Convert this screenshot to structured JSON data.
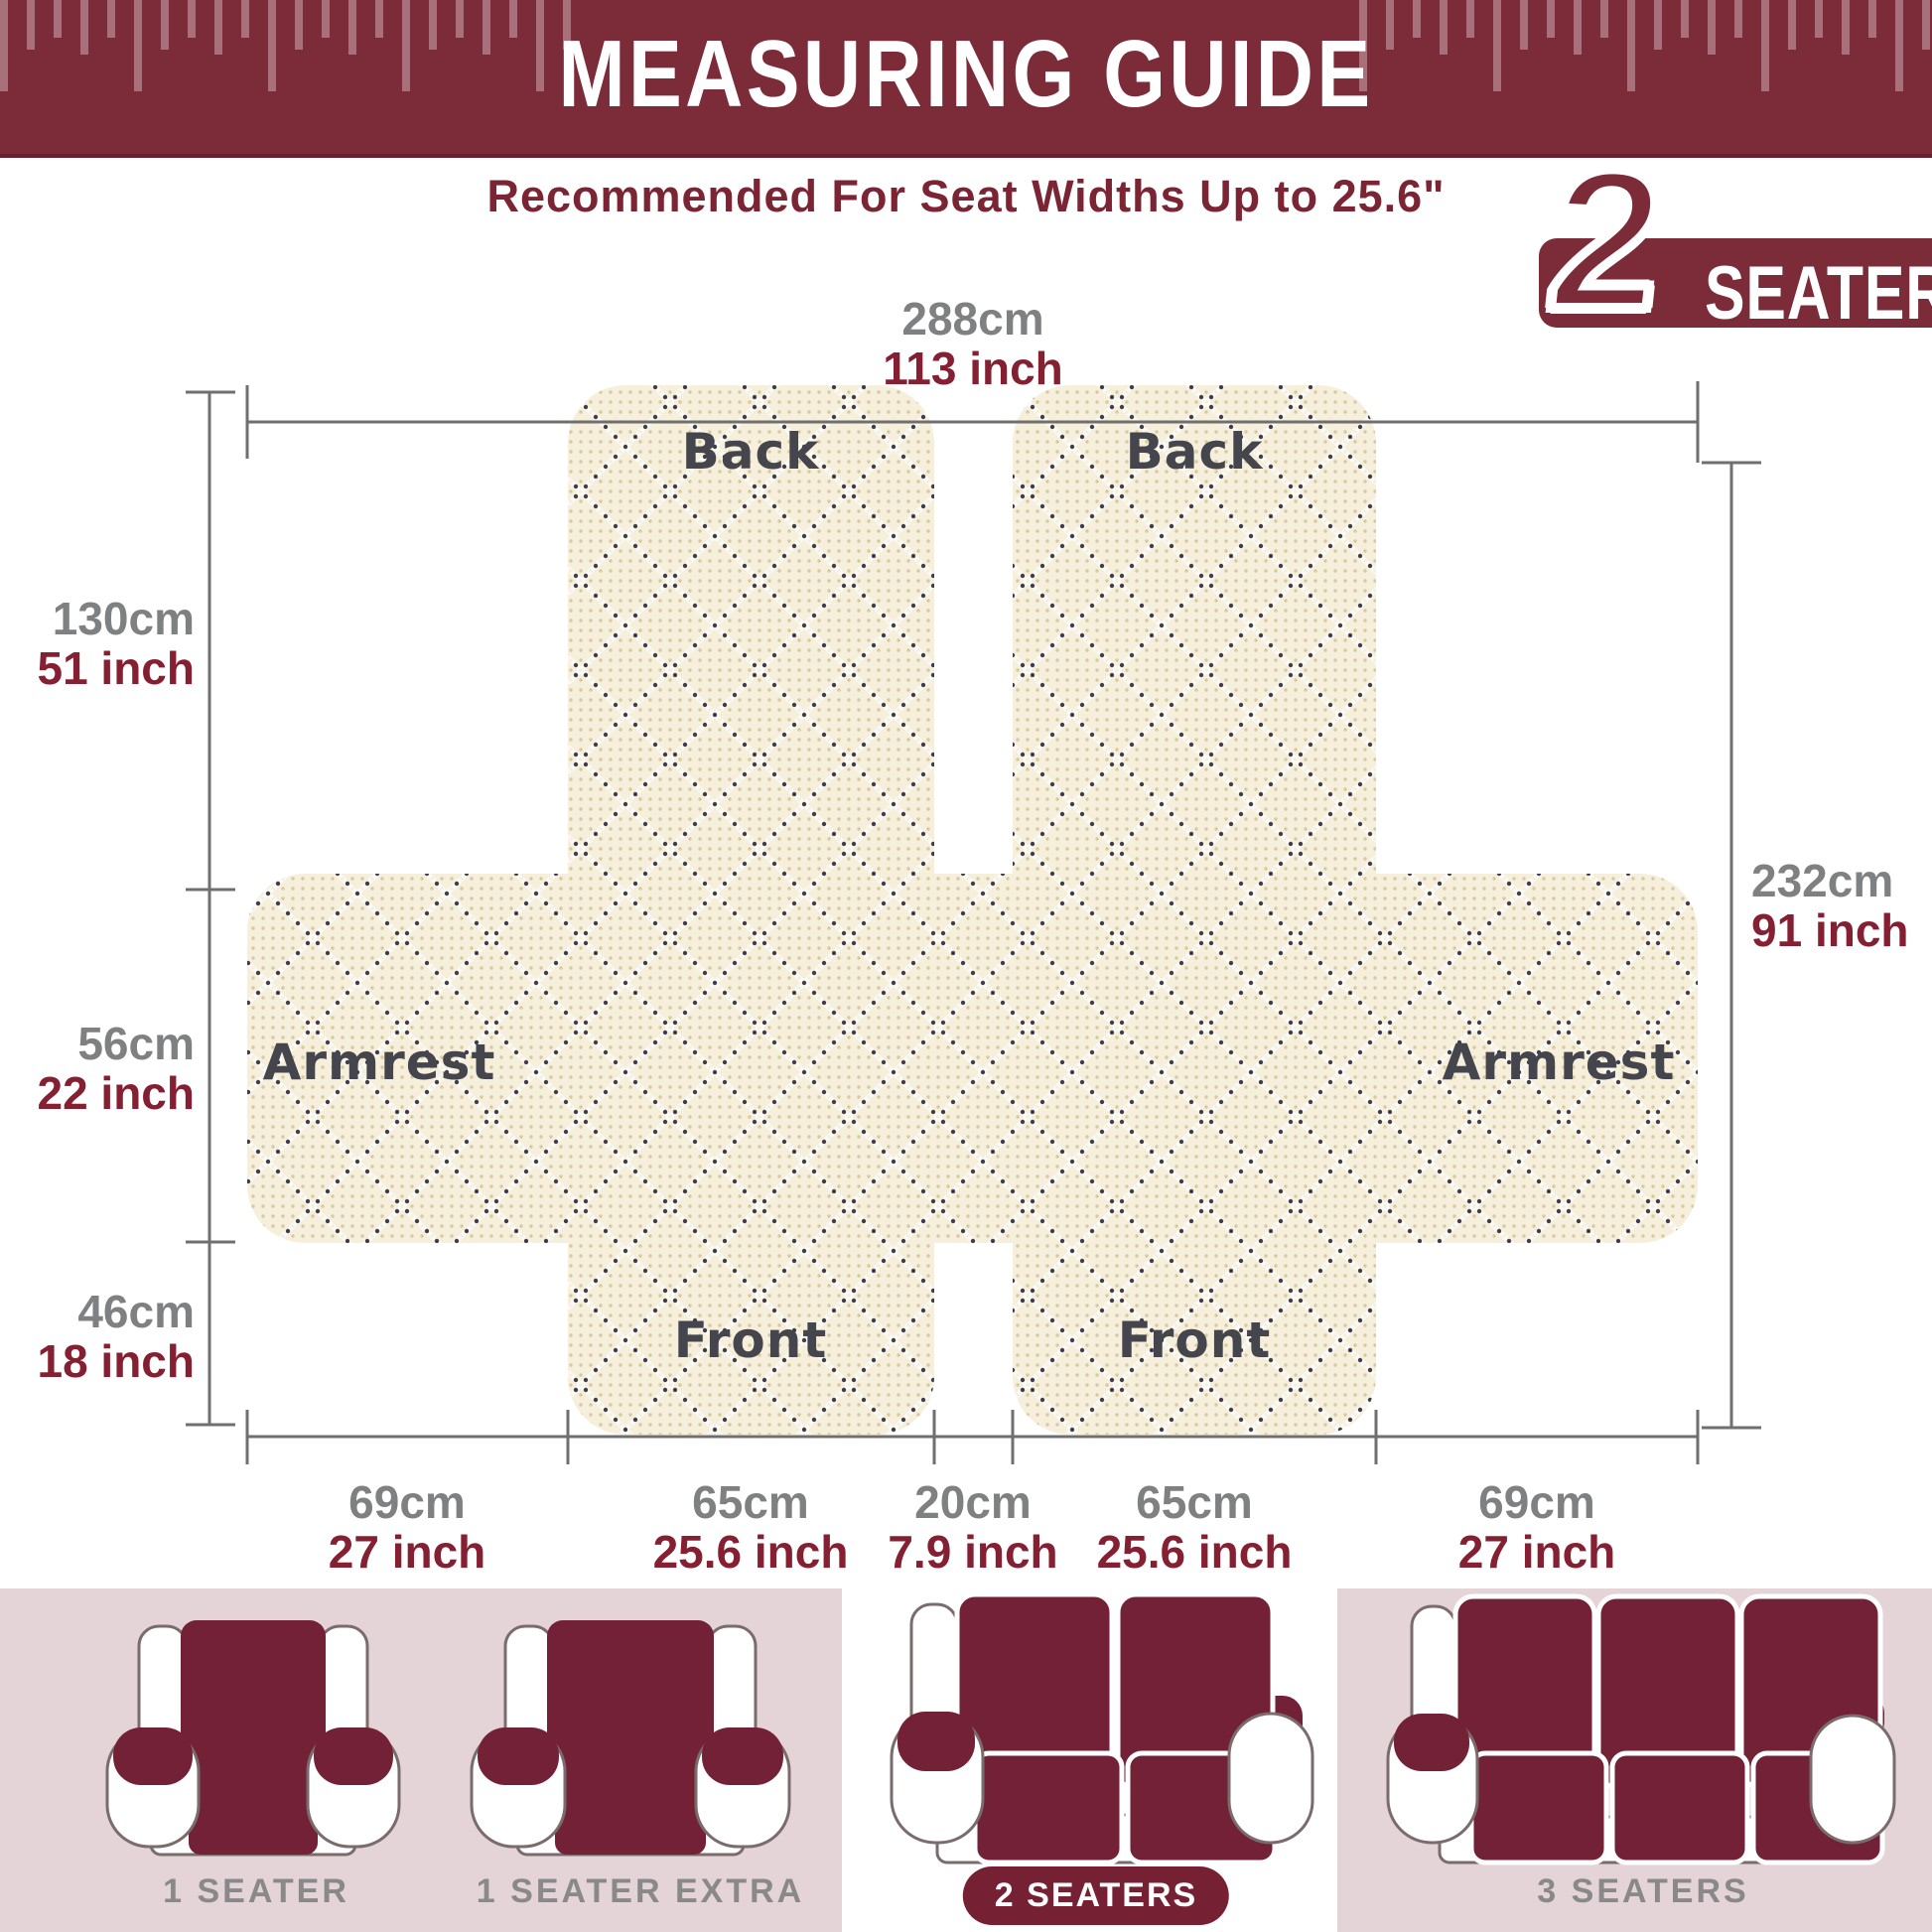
{
  "header": {
    "title": "MEASURING GUIDE"
  },
  "subtitle": "Recommended For Seat Widths Up to 25.6\"",
  "badge": {
    "number": "2",
    "label": "SEATER"
  },
  "dimensions": {
    "top": {
      "cm": "288cm",
      "inch": "113 inch"
    },
    "left": [
      {
        "cm": "130cm",
        "inch": "51 inch"
      },
      {
        "cm": "56cm",
        "inch": "22 inch"
      },
      {
        "cm": "46cm",
        "inch": "18 inch"
      }
    ],
    "right": {
      "cm": "232cm",
      "inch": "91 inch"
    },
    "bottom": [
      {
        "cm": "69cm",
        "inch": "27 inch"
      },
      {
        "cm": "65cm",
        "inch": "25.6 inch"
      },
      {
        "cm": "20cm",
        "inch": "7.9 inch"
      },
      {
        "cm": "65cm",
        "inch": "25.6 inch"
      },
      {
        "cm": "69cm",
        "inch": "27 inch"
      }
    ]
  },
  "panel_labels": {
    "back": "Back",
    "armrest": "Armrest",
    "front": "Front"
  },
  "thumbnails": [
    {
      "label": "1 SEATER",
      "selected": false
    },
    {
      "label": "1 SEATER EXTRA",
      "selected": false
    },
    {
      "label": "2 SEATERS",
      "selected": true
    },
    {
      "label": "3 SEATERS",
      "selected": false
    }
  ],
  "colors": {
    "maroon": "#7c2b39",
    "inch_text": "#842032",
    "cm_text": "#7e8082",
    "panel_label": "#45454d",
    "fabric_cream": "#f6efdb",
    "fabric_dot_tan": "#d8c9a0",
    "fabric_dot_dark": "#3f3f4c",
    "pink_background": "#e4d4d8",
    "chair_cover": "#722136",
    "dimension_line": "#6f6f6f",
    "thumb_label": "#898989"
  }
}
